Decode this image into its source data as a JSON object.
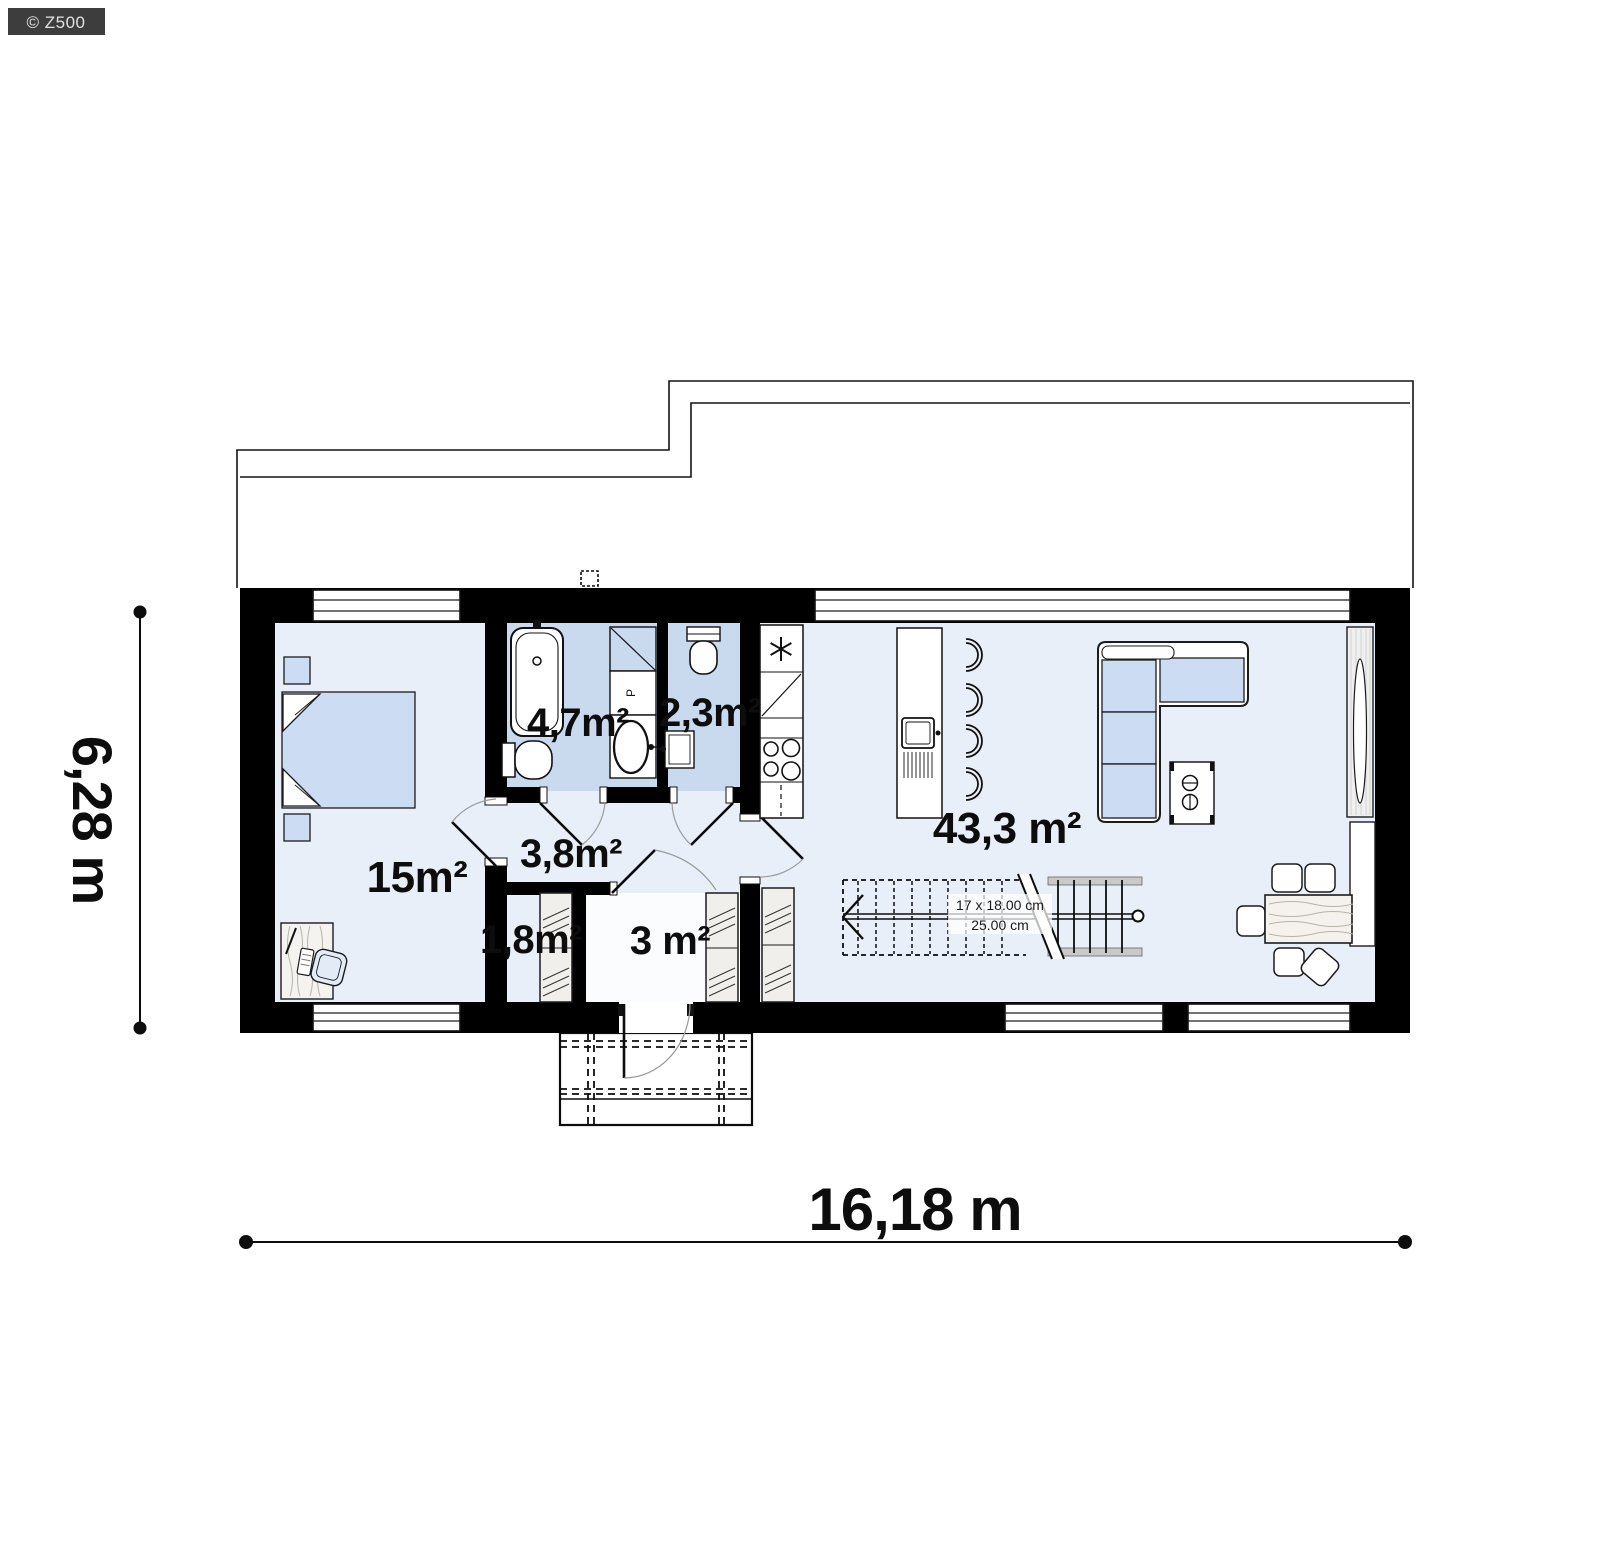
{
  "watermark": {
    "label": "© Z500"
  },
  "plan": {
    "room_labels": {
      "bedroom": "15m²",
      "bathroom": "4,7m²",
      "wc": "2,3m²",
      "hall": "3,8m²",
      "wardrobe": "1,8m²",
      "entry": "3 m²",
      "living": "43,3 m²"
    },
    "fixture_labels": {
      "bathroom_cabinet": "P"
    },
    "stairs": {
      "riser_label": "17 x 18.00 cm",
      "tread_label": "25.00 cm"
    },
    "dimensions": {
      "width": "16,18 m",
      "height": "6,28 m"
    },
    "colors": {
      "wall": "#000000",
      "floor_light": "#e9eff8",
      "floor_wet": "#c9daef",
      "floor_white": "#fbfcfe",
      "furniture_blue": "#ccdcf2",
      "badge_bg": "#3d3d3d",
      "badge_text": "#e2e2e2"
    }
  }
}
